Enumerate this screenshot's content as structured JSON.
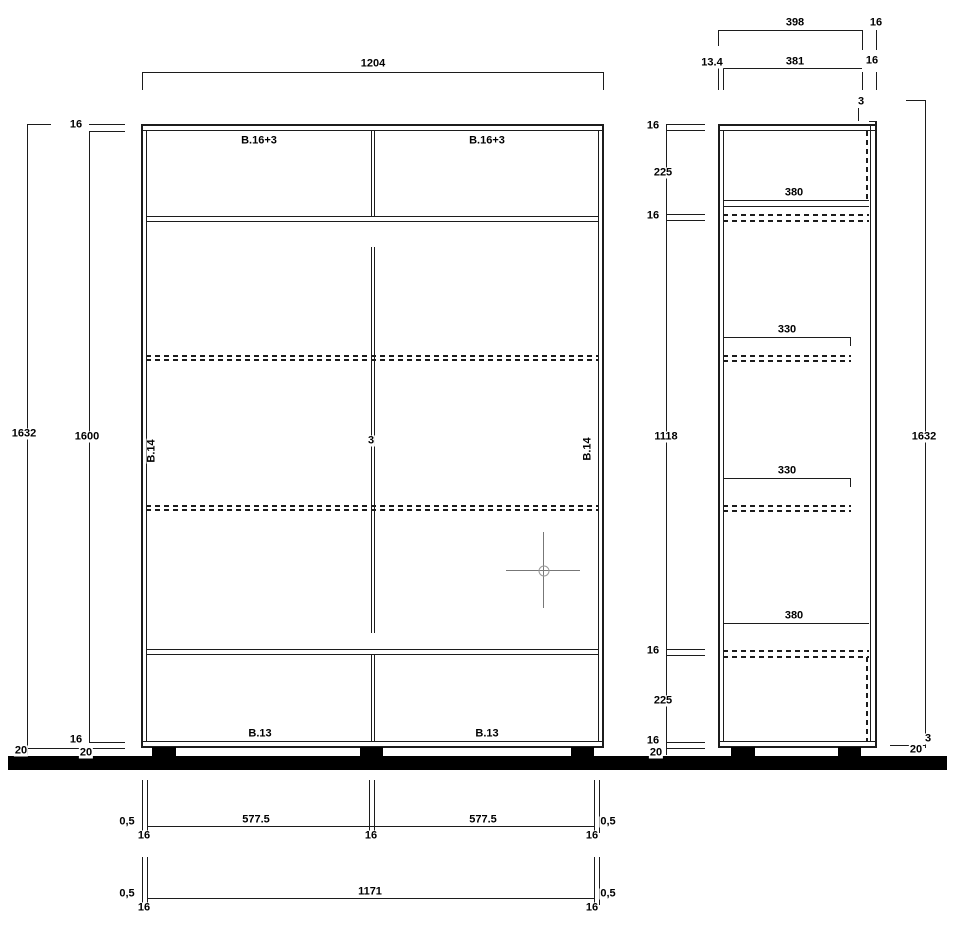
{
  "front_view": {
    "width_total": "1204",
    "labels": {
      "top_left": "B.16+3",
      "top_right": "B.16+3",
      "side_left": "B.14",
      "side_right": "B.14",
      "center_gap": "3",
      "bottom_left": "B.13",
      "bottom_right": "B.13"
    },
    "left_dims": {
      "height_total": "1632",
      "top_panel": "16",
      "height_inner": "1600",
      "bottom_panel": "16",
      "plinth_outer": "20",
      "plinth_inner": "20"
    },
    "bottom_row1": {
      "gap_left": "0,5",
      "panel_left": "16",
      "width_left": "577.5",
      "panel_mid": "16",
      "width_right": "577.5",
      "gap_right": "0,5",
      "panel_right": "16"
    },
    "bottom_row2": {
      "gap_left": "0,5",
      "panel_left": "16",
      "width_inner": "1171",
      "gap_right": "0,5",
      "panel_right": "16"
    }
  },
  "side_view": {
    "top_dims": {
      "depth_398": "398",
      "front_16": "16",
      "back_134": "13.4",
      "depth_381": "381",
      "panel_16": "16",
      "back_top_3": "3"
    },
    "left_dims": {
      "top_panel": "16",
      "section_top": "225",
      "shelf_top": "16",
      "section_mid": "1118",
      "shelf_bottom": "16",
      "section_bottom": "225",
      "bottom_panel": "16",
      "plinth": "20"
    },
    "shelves": {
      "depth_top": "380",
      "depth_upper": "330",
      "depth_lower": "330",
      "depth_bottom": "380"
    },
    "right_dims": {
      "height_total": "1632",
      "back_bottom_3": "3",
      "plinth": "20"
    }
  }
}
